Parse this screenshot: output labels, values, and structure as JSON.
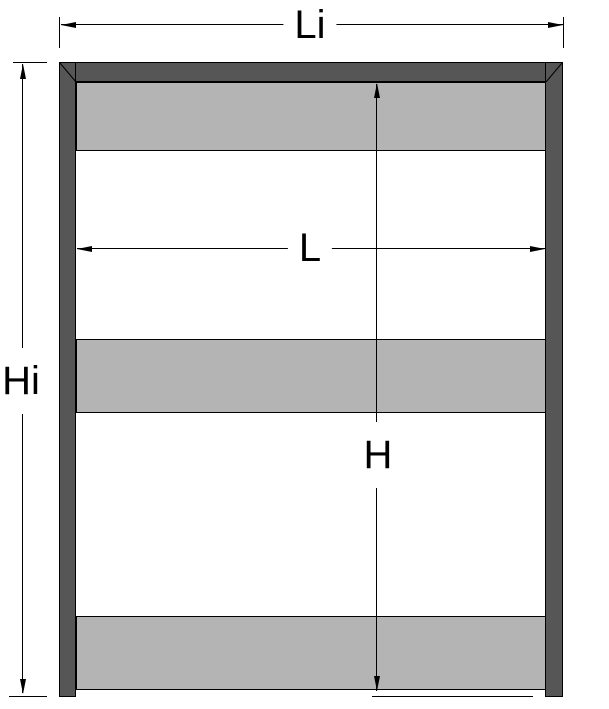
{
  "colors": {
    "background": "#ffffff",
    "frame": "#565656",
    "panel": "#b4b4b4",
    "line": "#000000"
  },
  "drawing": {
    "description": "Front elevation of a rectangular frame (two side posts and a mitred top rail) with three horizontal infill panels, annotated with four dimension lines"
  },
  "dimensions": {
    "overall_width": {
      "label": "Li"
    },
    "overall_height": {
      "label": "Hi"
    },
    "clear_width": {
      "label": "L"
    },
    "clear_height": {
      "label": "H"
    }
  }
}
